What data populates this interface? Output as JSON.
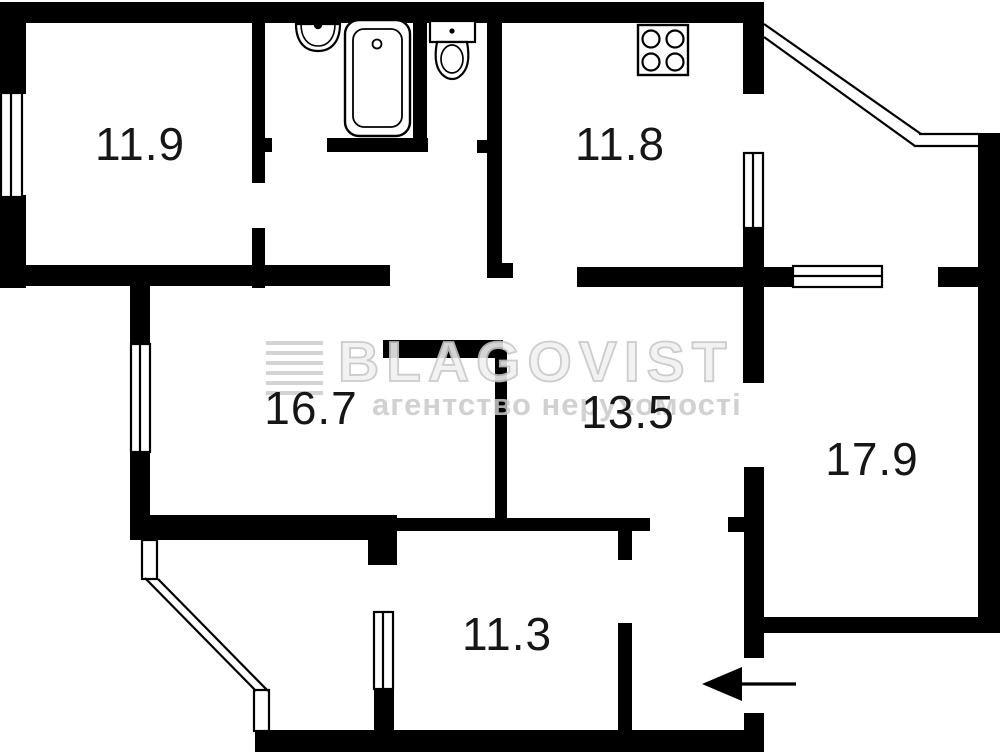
{
  "rooms": [
    {
      "key": "bedroom-top-left",
      "label": "11.9"
    },
    {
      "key": "kitchen",
      "label": "11.8"
    },
    {
      "key": "living-room",
      "label": "16.7"
    },
    {
      "key": "bedroom-middle",
      "label": "13.5"
    },
    {
      "key": "bedroom-right",
      "label": "17.9"
    },
    {
      "key": "bedroom-bottom",
      "label": "11.3"
    }
  ],
  "watermark": {
    "brand": "BLAGOVIST",
    "tagline": "агентство нерухомості"
  },
  "fixtures": [
    "sink",
    "bathtub",
    "toilet",
    "stove"
  ],
  "entrance": {
    "direction": "left"
  },
  "colors": {
    "wall": "#000000",
    "floor": "#ffffff",
    "watermark_text": "#c9c9c9"
  }
}
